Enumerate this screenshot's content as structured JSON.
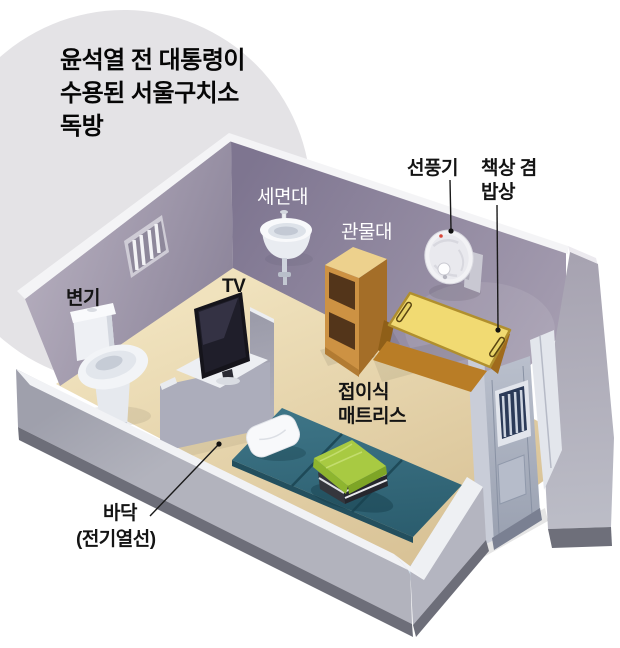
{
  "title": {
    "lines": [
      "윤석열 전 대통령이",
      "수용된 서울구치소",
      "독방"
    ]
  },
  "labels": {
    "toilet": "변기",
    "washbasin": "세면대",
    "locker": "관물대",
    "fan": "선풍기",
    "desk_line1": "책상 겸",
    "desk_line2": "밥상",
    "tv": "TV",
    "mattress_line1": "접이식",
    "mattress_line2": "매트리스",
    "floor_line1": "바닥",
    "floor_line2": "(전기열선)"
  },
  "colors": {
    "background": "#ffffff",
    "title_circle": "#e4e3e6",
    "wall_left": "#9b93a8",
    "wall_right": "#8d8499",
    "wall_top_edge": "#f4f4f6",
    "floor": "#e7d6ae",
    "low_wall_inner": "#cddce8",
    "low_wall_outer": "#a7a8b4",
    "low_wall_base": "#6d6e79",
    "mattress": "#33697b",
    "blanket": "#a8ca42",
    "pillow": "#f8f9fb",
    "desk": "#f1da72",
    "desk_frame": "#b97d26",
    "locker_wood": "#cd9243",
    "door": "#aab1c0",
    "door_window_bars": "#2b3a58",
    "label_dark": "#141414",
    "label_light": "#ffffff",
    "leader_line": "#1a1a1a"
  },
  "objects": [
    "toilet",
    "barred-window",
    "washbasin",
    "locker",
    "wall-fan",
    "folding-desk",
    "tv",
    "folding-mattress",
    "pillow",
    "folded-blanket",
    "cell-door",
    "heated-floor"
  ]
}
